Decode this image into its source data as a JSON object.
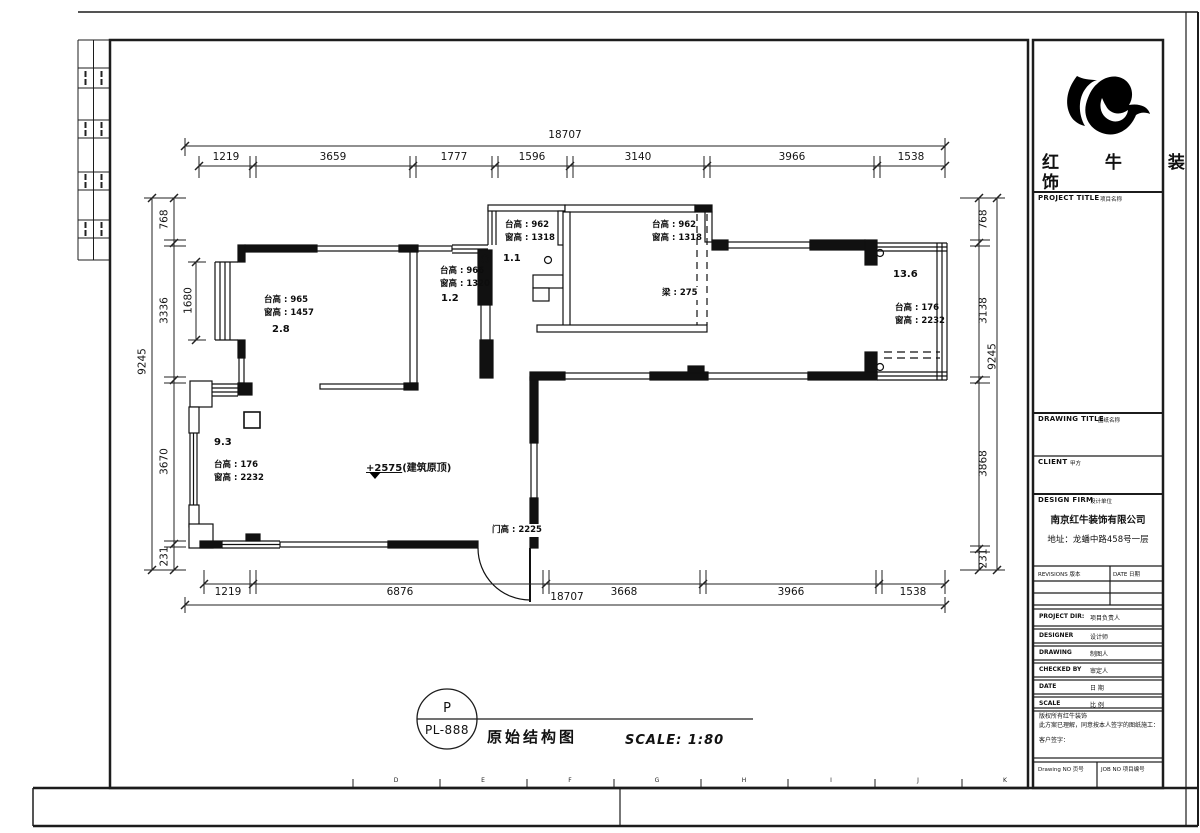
{
  "colors": {
    "ink": "#111111",
    "paper": "#ffffff"
  },
  "drawing": {
    "dims": {
      "top_overall": "18707",
      "top_segments": [
        "1219",
        "3659",
        "1777",
        "1596",
        "3140",
        "3966",
        "1538"
      ],
      "bottom_segments": [
        "1219",
        "6876",
        "3668",
        "3966",
        "1538"
      ],
      "bottom_overall": "18707",
      "left_overall": "9245",
      "left_segments": [
        "768",
        "3336",
        "3670",
        "231"
      ],
      "right_overall": "9245",
      "right_segments": [
        "768",
        "3138",
        "3868",
        "231"
      ],
      "interior_window": "1680"
    },
    "annotations": {
      "room_nw": "台高 : 965\n窗高 : 1457",
      "room_nw_area": "2.8",
      "hall": "台高 : 966\n窗高 : 1320",
      "hall_area": "1.2",
      "room_n1_area": "1.1",
      "room_n1": "台高 : 962\n窗高 : 1318",
      "room_n2": "台高 : 962\n窗高 : 1318",
      "beam": "梁 : 275",
      "room_e_area": "13.6",
      "room_e": "台高 : 176\n窗高 : 2232",
      "living_area": "9.3",
      "living": "台高 : 176\n窗高 : 2232",
      "door_height": "门高 : 2225",
      "level_value": "+2575",
      "level_note": "(建筑原顶)"
    },
    "grid_letters": [
      "D",
      "E",
      "F",
      "G",
      "H",
      "I",
      "J",
      "K"
    ]
  },
  "stamp": {
    "letter": "P",
    "code": "PL-888",
    "title": "原始结构图",
    "scale": "SCALE: 1:80"
  },
  "title_block": {
    "logo_line1": "红 牛 装",
    "logo_line2": "饰",
    "project_title": "PROJECT TITLE",
    "project_title_cn": "项目名称",
    "drawing_title": "DRAWING TITLE",
    "drawing_title_cn": "图纸名称",
    "client": "CLIENT",
    "client_cn": "甲方",
    "design_firm": "DESIGN FIRM",
    "design_firm_cn": "设计单位",
    "firm_name": "南京红牛装饰有限公司",
    "firm_address": "地址：龙蟠中路458号一层",
    "revisions_label": "REVISIONS 版本",
    "date_label": "DATE 日期",
    "rows": [
      {
        "en": "PROJECT DIR:",
        "cn": "项目负责人"
      },
      {
        "en": "DESIGNER",
        "cn": "设计师"
      },
      {
        "en": "DRAWING",
        "cn": "制图人"
      },
      {
        "en": "CHECKED BY",
        "cn": "审定人"
      },
      {
        "en": "DATE",
        "cn": "日 期"
      },
      {
        "en": "SCALE",
        "cn": "比 例"
      }
    ],
    "notice_line1": "版权所有红牛装饰",
    "notice_line2": "此方案已理解，同意按本人签字的图纸施工：",
    "notice_line3": "客户签字：",
    "drawing_no_label": "Drawing NO 页号",
    "job_no_label": "JOB NO 项目编号"
  }
}
